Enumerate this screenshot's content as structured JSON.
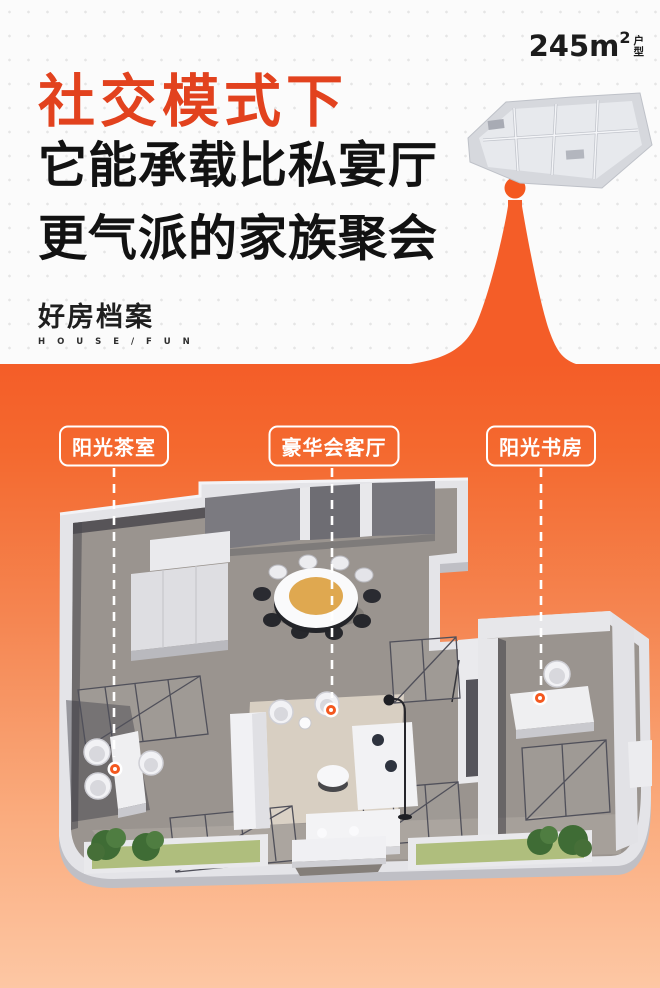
{
  "poster": {
    "area_badge": {
      "value": "245m",
      "sup": "2",
      "unit_top": "户",
      "unit_bottom": "型"
    },
    "title": {
      "line1": "社交模式下",
      "line2": "它能承载比私宴厅",
      "line3": "更气派的家族聚会",
      "accent_color": "#E2421E",
      "text_color": "#121212"
    },
    "logo": {
      "cn": "好房档案",
      "en": "H O U S E / F U N"
    },
    "colors": {
      "orange_top": "#F45D28",
      "orange_bottom": "#FDC7A4",
      "background": "#FBFBFB",
      "marker": "#F4581F"
    }
  },
  "floorplan": {
    "room_labels": [
      {
        "text": "阳光茶室"
      },
      {
        "text": "豪华会客厅"
      },
      {
        "text": "阳光书房"
      }
    ]
  }
}
